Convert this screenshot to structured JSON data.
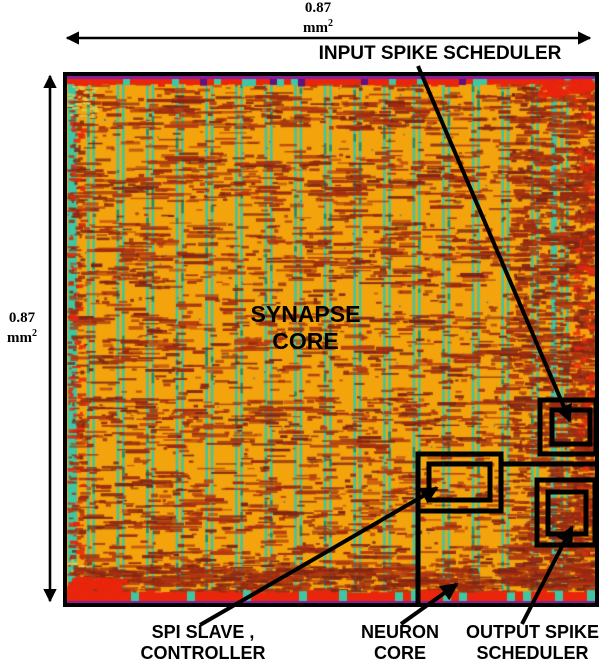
{
  "dimensions": {
    "top": {
      "value": "0.87",
      "unit": "mm",
      "power": "2"
    },
    "left": {
      "value": "0.87",
      "unit": "mm",
      "power": "2"
    }
  },
  "annotations": {
    "input_scheduler": {
      "label": "INPUT SPIKE SCHEDULER"
    },
    "synapse_core": {
      "line1": "SYNAPSE",
      "line2": "CORE"
    },
    "spi_controller": {
      "line1": "SPI SLAVE ,",
      "line2": "CONTROLLER"
    },
    "neuron_core": {
      "line1": "NEURON",
      "line2": "CORE"
    },
    "output_scheduler": {
      "line1": "OUTPUT SPIKE",
      "line2": "SCHEDULER"
    }
  },
  "die": {
    "colors": {
      "base_orange": "#F3A30C",
      "stripe_teal": "#3EC7A2",
      "stripe_teal_dark": "#1E8F74",
      "speckle_maroon": "#9E2B10",
      "speckle_dark": "#7C2416",
      "speckle_light": "#B53A12",
      "edge_red": "#E9260C",
      "edge_magenta": "#8A1E96",
      "fleck_yellow": "#E2CE4A",
      "dot_blue": "#2E66B8",
      "border_black": "#000000"
    }
  }
}
